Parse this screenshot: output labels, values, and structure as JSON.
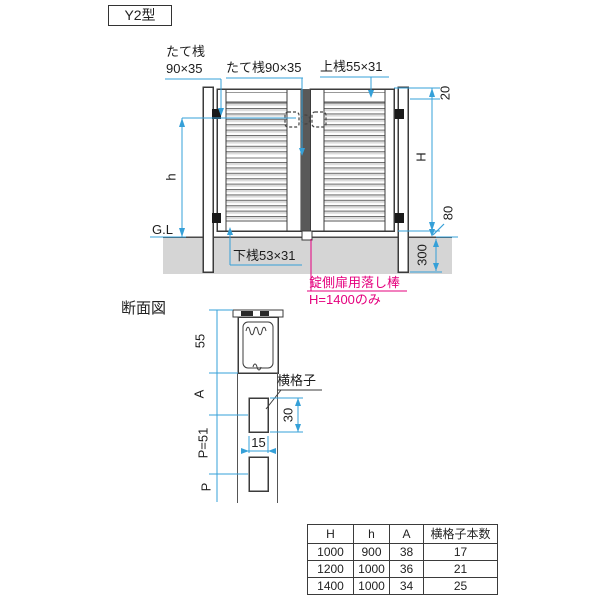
{
  "title": "Y2型",
  "colors": {
    "dimension_blue": "#35a0d8",
    "note_magenta": "#e5007e",
    "line_dark": "#3b3b3b",
    "ground_gray": "#d5d5d5"
  },
  "front_view": {
    "labels": {
      "stile_left_line1": "たて桟",
      "stile_left_line2": "90×35",
      "stile_center": "たて桟90×35",
      "top_rail": "上桟55×31",
      "bottom_rail": "下桟53×31",
      "ground_level": "G.L"
    },
    "dims": {
      "top_clearance": "20",
      "gate_height": "H",
      "leaf_height": "h",
      "bottom_clearance": "80",
      "embed_depth": "300"
    },
    "note": {
      "line1": "錠側扉用落し棒",
      "line2": "H=1400のみ"
    }
  },
  "section_view": {
    "title": "断面図",
    "label_lattice": "横格子",
    "dims": {
      "top_rail_height": "55",
      "a": "A",
      "pitch": "P=51",
      "p": "P",
      "lattice_height": "30",
      "lattice_width": "15"
    }
  },
  "spec_table": {
    "headers": [
      "H",
      "h",
      "A",
      "横格子本数"
    ],
    "rows": [
      [
        "1000",
        "900",
        "38",
        "17"
      ],
      [
        "1200",
        "1000",
        "36",
        "21"
      ],
      [
        "1400",
        "1000",
        "34",
        "25"
      ]
    ]
  }
}
